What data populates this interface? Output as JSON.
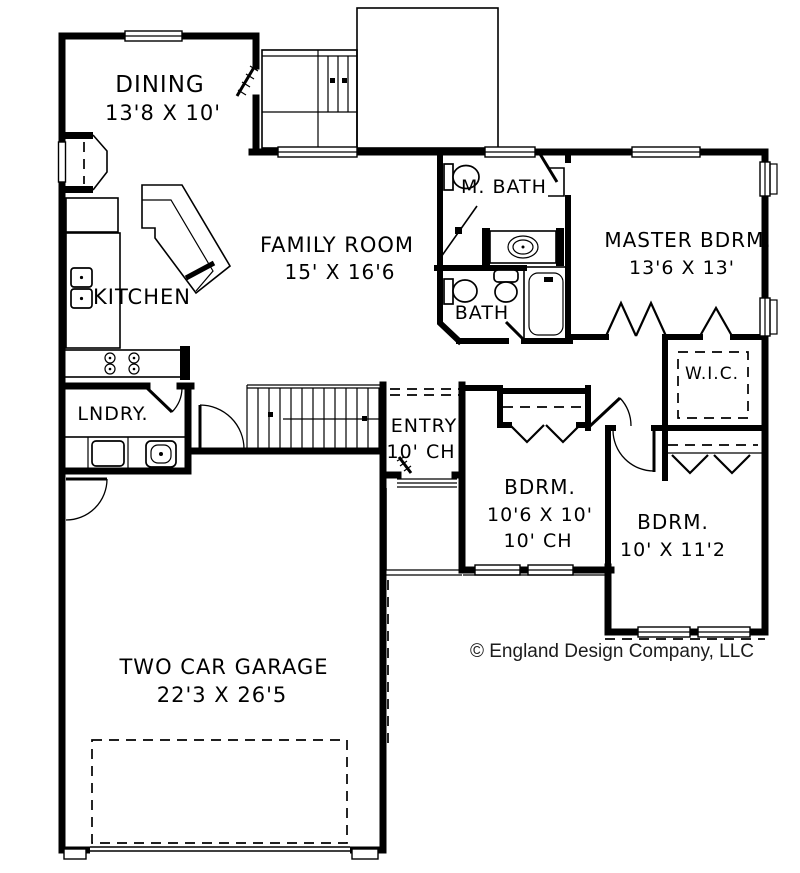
{
  "plan": {
    "title": "House Floor Plan",
    "colors": {
      "line": "#000000",
      "background": "#ffffff",
      "text": "#000000"
    },
    "rooms": {
      "dining": {
        "name": "DINING",
        "dims": "13'8 X 10'"
      },
      "kitchen": {
        "name": "KITCHEN"
      },
      "family_room": {
        "name": "FAMILY ROOM",
        "dims": "15' X 16'6"
      },
      "master_bath": {
        "name": "M. BATH"
      },
      "master_bedroom": {
        "name": "MASTER BDRM.",
        "dims": "13'6 X 13'"
      },
      "bath": {
        "name": "BATH"
      },
      "walk_in_closet": {
        "name": "W.I.C."
      },
      "laundry": {
        "name": "LNDRY."
      },
      "entry": {
        "name": "ENTRY",
        "ceiling": "10' CH"
      },
      "bedroom_1": {
        "name": "BDRM.",
        "dims": "10'6 X 10'",
        "ceiling": "10' CH"
      },
      "bedroom_2": {
        "name": "BDRM.",
        "dims": "10' X 11'2"
      },
      "garage": {
        "name": "TWO CAR GARAGE",
        "dims": "22'3 X 26'5"
      }
    },
    "copyright": "© England Design Company, LLC"
  }
}
